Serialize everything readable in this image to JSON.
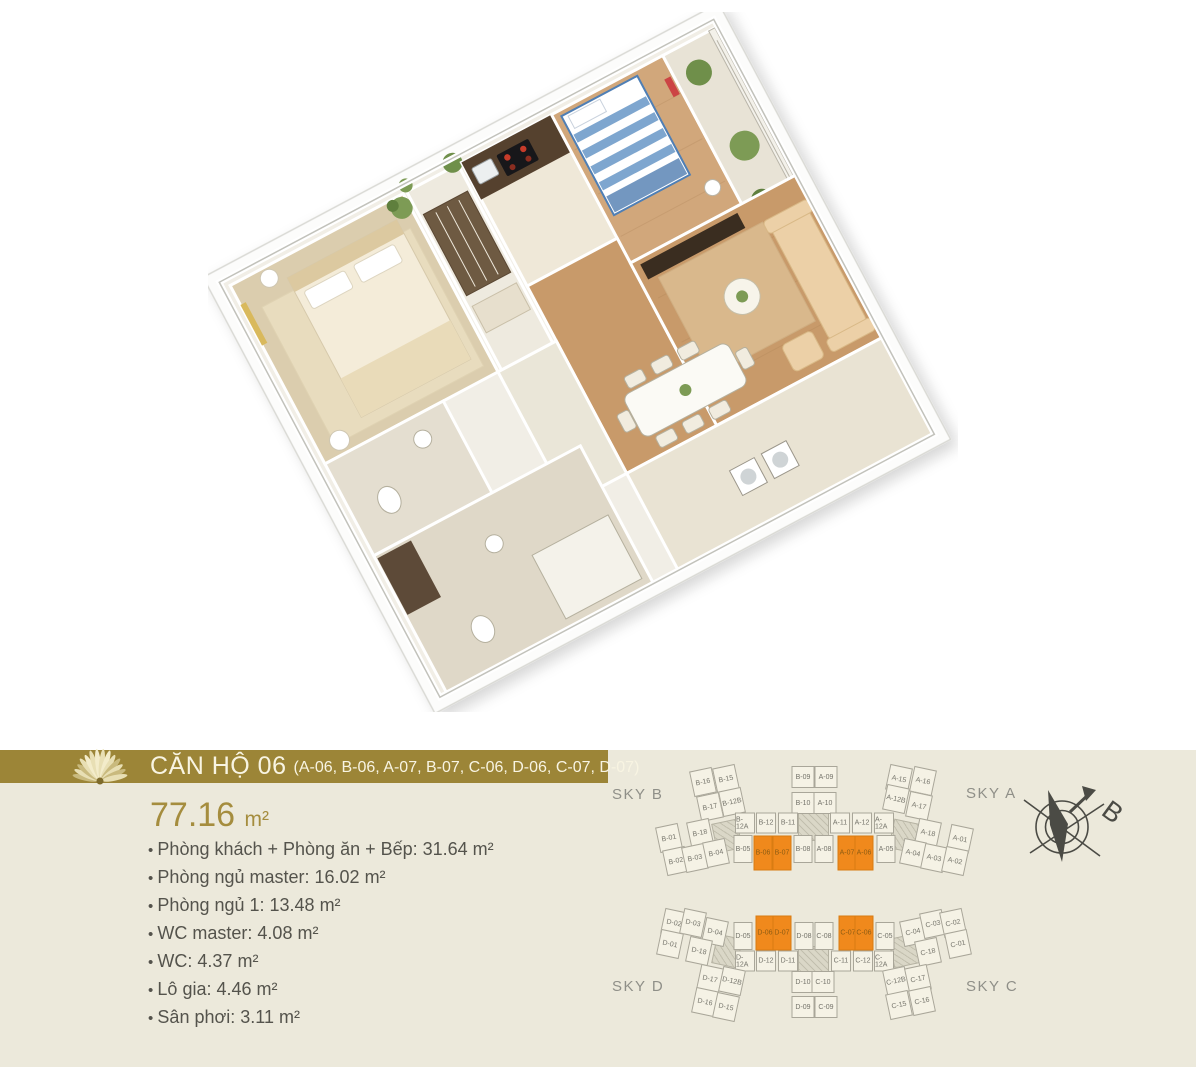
{
  "header": {
    "title": "CĂN HỘ 06",
    "units_list": "(A-06, B-06, A-07, B-07, C-06, D-06, C-07, D-07)"
  },
  "summary": {
    "area_value": "77.16",
    "area_unit": "m²",
    "specs": [
      "Phòng khách + Phòng ăn + Bếp: 31.64 m²",
      "Phòng ngủ master: 16.02 m²",
      "Phòng ngủ 1: 13.48 m²",
      "WC master: 4.08 m²",
      "WC: 4.37 m²",
      "Lô gia: 4.46 m²",
      "Sân phơi: 3.11 m²"
    ]
  },
  "site_plan": {
    "sky_labels": {
      "sky_b": "SKY B",
      "sky_a": "SKY A",
      "sky_d": "SKY D",
      "sky_c": "SKY C"
    },
    "compass_label": "B",
    "highlighted_units": [
      "B-06",
      "B-07",
      "A-07",
      "A-06",
      "D-06",
      "D-07",
      "C-07",
      "C-06"
    ],
    "units": [
      {
        "l": "B-16",
        "x": 703,
        "y": 32,
        "t": "wing",
        "r": -12
      },
      {
        "l": "B-15",
        "x": 726,
        "y": 29,
        "t": "wing",
        "r": -12
      },
      {
        "l": "B-17",
        "x": 710,
        "y": 57,
        "t": "wing",
        "r": -12
      },
      {
        "l": "B-12B",
        "x": 732,
        "y": 52,
        "t": "wing",
        "r": -12
      },
      {
        "l": "B-01",
        "x": 669,
        "y": 88,
        "t": "wing",
        "r": -12
      },
      {
        "l": "B-18",
        "x": 700,
        "y": 83,
        "t": "wing",
        "r": -12
      },
      {
        "l": "B-02",
        "x": 676,
        "y": 111,
        "t": "wing",
        "r": -12
      },
      {
        "l": "B-03",
        "x": 695,
        "y": 108,
        "t": "wing",
        "r": -12
      },
      {
        "l": "B-04",
        "x": 716,
        "y": 103,
        "t": "wing",
        "r": -12
      },
      {
        "l": "B-09",
        "x": 803,
        "y": 27,
        "t": "stack"
      },
      {
        "l": "A-09",
        "x": 826,
        "y": 27,
        "t": "stack"
      },
      {
        "l": "B-10",
        "x": 803,
        "y": 53,
        "t": "stack"
      },
      {
        "l": "A-10",
        "x": 825,
        "y": 53,
        "t": "stack"
      },
      {
        "l": "B-12A",
        "x": 745,
        "y": 73,
        "t": "band2"
      },
      {
        "l": "B-12",
        "x": 766,
        "y": 73,
        "t": "band2"
      },
      {
        "l": "B-11",
        "x": 788,
        "y": 73,
        "t": "band2"
      },
      {
        "l": "A-11",
        "x": 840,
        "y": 73,
        "t": "band2"
      },
      {
        "l": "A-12",
        "x": 862,
        "y": 73,
        "t": "band2"
      },
      {
        "l": "A-12A",
        "x": 884,
        "y": 73,
        "t": "band2"
      },
      {
        "l": "B-05",
        "x": 743,
        "y": 99,
        "t": "band"
      },
      {
        "l": "B-06",
        "x": 763,
        "y": 103,
        "t": "hl"
      },
      {
        "l": "B-07",
        "x": 782,
        "y": 103,
        "t": "hl"
      },
      {
        "l": "B-08",
        "x": 803,
        "y": 99,
        "t": "band"
      },
      {
        "l": "A-08",
        "x": 824,
        "y": 99,
        "t": "band"
      },
      {
        "l": "A-07",
        "x": 847,
        "y": 103,
        "t": "hl"
      },
      {
        "l": "A-06",
        "x": 864,
        "y": 103,
        "t": "hl"
      },
      {
        "l": "A-05",
        "x": 886,
        "y": 99,
        "t": "band"
      },
      {
        "l": "A-15",
        "x": 899,
        "y": 29,
        "t": "wing",
        "r": 12
      },
      {
        "l": "A-16",
        "x": 923,
        "y": 31,
        "t": "wing",
        "r": 12
      },
      {
        "l": "A-12B",
        "x": 896,
        "y": 49,
        "t": "wing",
        "r": 12
      },
      {
        "l": "A-17",
        "x": 919,
        "y": 56,
        "t": "wing",
        "r": 12
      },
      {
        "l": "A-18",
        "x": 928,
        "y": 83,
        "t": "wing",
        "r": 12
      },
      {
        "l": "A-01",
        "x": 960,
        "y": 89,
        "t": "wing",
        "r": 12
      },
      {
        "l": "A-04",
        "x": 913,
        "y": 103,
        "t": "wing",
        "r": 12
      },
      {
        "l": "A-03",
        "x": 934,
        "y": 108,
        "t": "wing",
        "r": 12
      },
      {
        "l": "A-02",
        "x": 955,
        "y": 111,
        "t": "wing",
        "r": 12
      },
      {
        "l": "D-02",
        "x": 674,
        "y": 173,
        "t": "wing",
        "r": 12
      },
      {
        "l": "D-03",
        "x": 693,
        "y": 173,
        "t": "wing",
        "r": 12
      },
      {
        "l": "D-04",
        "x": 715,
        "y": 182,
        "t": "wing",
        "r": 12
      },
      {
        "l": "D-01",
        "x": 670,
        "y": 194,
        "t": "wing",
        "r": 12
      },
      {
        "l": "D-18",
        "x": 699,
        "y": 201,
        "t": "wing",
        "r": 12
      },
      {
        "l": "D-05",
        "x": 743,
        "y": 186,
        "t": "band"
      },
      {
        "l": "D-06",
        "x": 765,
        "y": 183,
        "t": "hl"
      },
      {
        "l": "D-07",
        "x": 782,
        "y": 183,
        "t": "hl"
      },
      {
        "l": "D-08",
        "x": 804,
        "y": 186,
        "t": "band"
      },
      {
        "l": "C-08",
        "x": 824,
        "y": 186,
        "t": "band"
      },
      {
        "l": "C-07",
        "x": 848,
        "y": 183,
        "t": "hl"
      },
      {
        "l": "C-06",
        "x": 864,
        "y": 183,
        "t": "hl"
      },
      {
        "l": "C-05",
        "x": 885,
        "y": 186,
        "t": "band"
      },
      {
        "l": "D-12A",
        "x": 745,
        "y": 211,
        "t": "band2"
      },
      {
        "l": "D-12",
        "x": 766,
        "y": 211,
        "t": "band2"
      },
      {
        "l": "D-11",
        "x": 788,
        "y": 211,
        "t": "band2"
      },
      {
        "l": "C-11",
        "x": 841,
        "y": 211,
        "t": "band2"
      },
      {
        "l": "C-12",
        "x": 863,
        "y": 211,
        "t": "band2"
      },
      {
        "l": "C-12A",
        "x": 884,
        "y": 211,
        "t": "band2"
      },
      {
        "l": "D-17",
        "x": 710,
        "y": 229,
        "t": "wing",
        "r": 12
      },
      {
        "l": "D-12B",
        "x": 732,
        "y": 231,
        "t": "wing",
        "r": 12
      },
      {
        "l": "D-16",
        "x": 705,
        "y": 252,
        "t": "wing",
        "r": 12
      },
      {
        "l": "D-15",
        "x": 726,
        "y": 257,
        "t": "wing",
        "r": 12
      },
      {
        "l": "D-10",
        "x": 803,
        "y": 232,
        "t": "stack"
      },
      {
        "l": "C-10",
        "x": 823,
        "y": 232,
        "t": "stack"
      },
      {
        "l": "D-09",
        "x": 803,
        "y": 257,
        "t": "stack"
      },
      {
        "l": "C-09",
        "x": 826,
        "y": 257,
        "t": "stack"
      },
      {
        "l": "C-04",
        "x": 913,
        "y": 182,
        "t": "wing",
        "r": -12
      },
      {
        "l": "C-03",
        "x": 933,
        "y": 174,
        "t": "wing",
        "r": -12
      },
      {
        "l": "C-02",
        "x": 953,
        "y": 173,
        "t": "wing",
        "r": -12
      },
      {
        "l": "C-18",
        "x": 928,
        "y": 202,
        "t": "wing",
        "r": -12
      },
      {
        "l": "C-01",
        "x": 958,
        "y": 194,
        "t": "wing",
        "r": -12
      },
      {
        "l": "C-12B",
        "x": 896,
        "y": 231,
        "t": "wing",
        "r": -12
      },
      {
        "l": "C-17",
        "x": 918,
        "y": 229,
        "t": "wing",
        "r": -12
      },
      {
        "l": "C-15",
        "x": 899,
        "y": 255,
        "t": "wing",
        "r": -12
      },
      {
        "l": "C-16",
        "x": 922,
        "y": 251,
        "t": "wing",
        "r": -12
      }
    ]
  },
  "colors": {
    "accent_gold": "#9C8537",
    "highlight_orange": "#F0891C",
    "panel_bg": "#ECE9DB",
    "spec_text": "#54534C",
    "sky_label": "#8F8F88"
  }
}
